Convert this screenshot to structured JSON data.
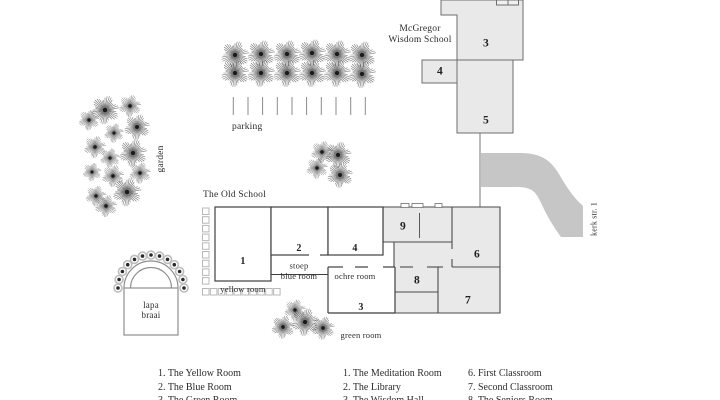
{
  "school": {
    "name": "McGregor\nWisdom School",
    "building3": "3",
    "building4": "4",
    "building5": "5"
  },
  "old_school": {
    "title": "The Old School",
    "room1": {
      "num": "1",
      "name": "yellow room"
    },
    "room2": {
      "num": "2",
      "name": "blue room"
    },
    "room4": {
      "num": "4",
      "name": "ochre room"
    },
    "room3": {
      "num": "3",
      "name": "green room"
    },
    "room9": "9",
    "room6": "6",
    "room8": "8",
    "room7": "7",
    "stoep": "stoep"
  },
  "labels": {
    "garden": "garden",
    "parking": "parking",
    "lapa_braai": "lapa\nbraai",
    "street": "kerk str. 1"
  },
  "legend": {
    "old_school_rooms": [
      "1. The Yellow Room",
      "2. The Blue Room",
      "3. The Green Room"
    ],
    "school_rooms": [
      "1. The Meditation Room",
      "2. The Library",
      "3. The Wisdom Hall"
    ],
    "classrooms": [
      "6. First Classroom",
      "7. Second Classroom",
      "8. The Seniors Room"
    ]
  },
  "colors": {
    "building_fill": "#e9e9e9",
    "road": "#c6c6c6",
    "outline_dark": "#3f3f3f",
    "outline_light": "#6e6e6e",
    "text": "#2b2b2b"
  }
}
